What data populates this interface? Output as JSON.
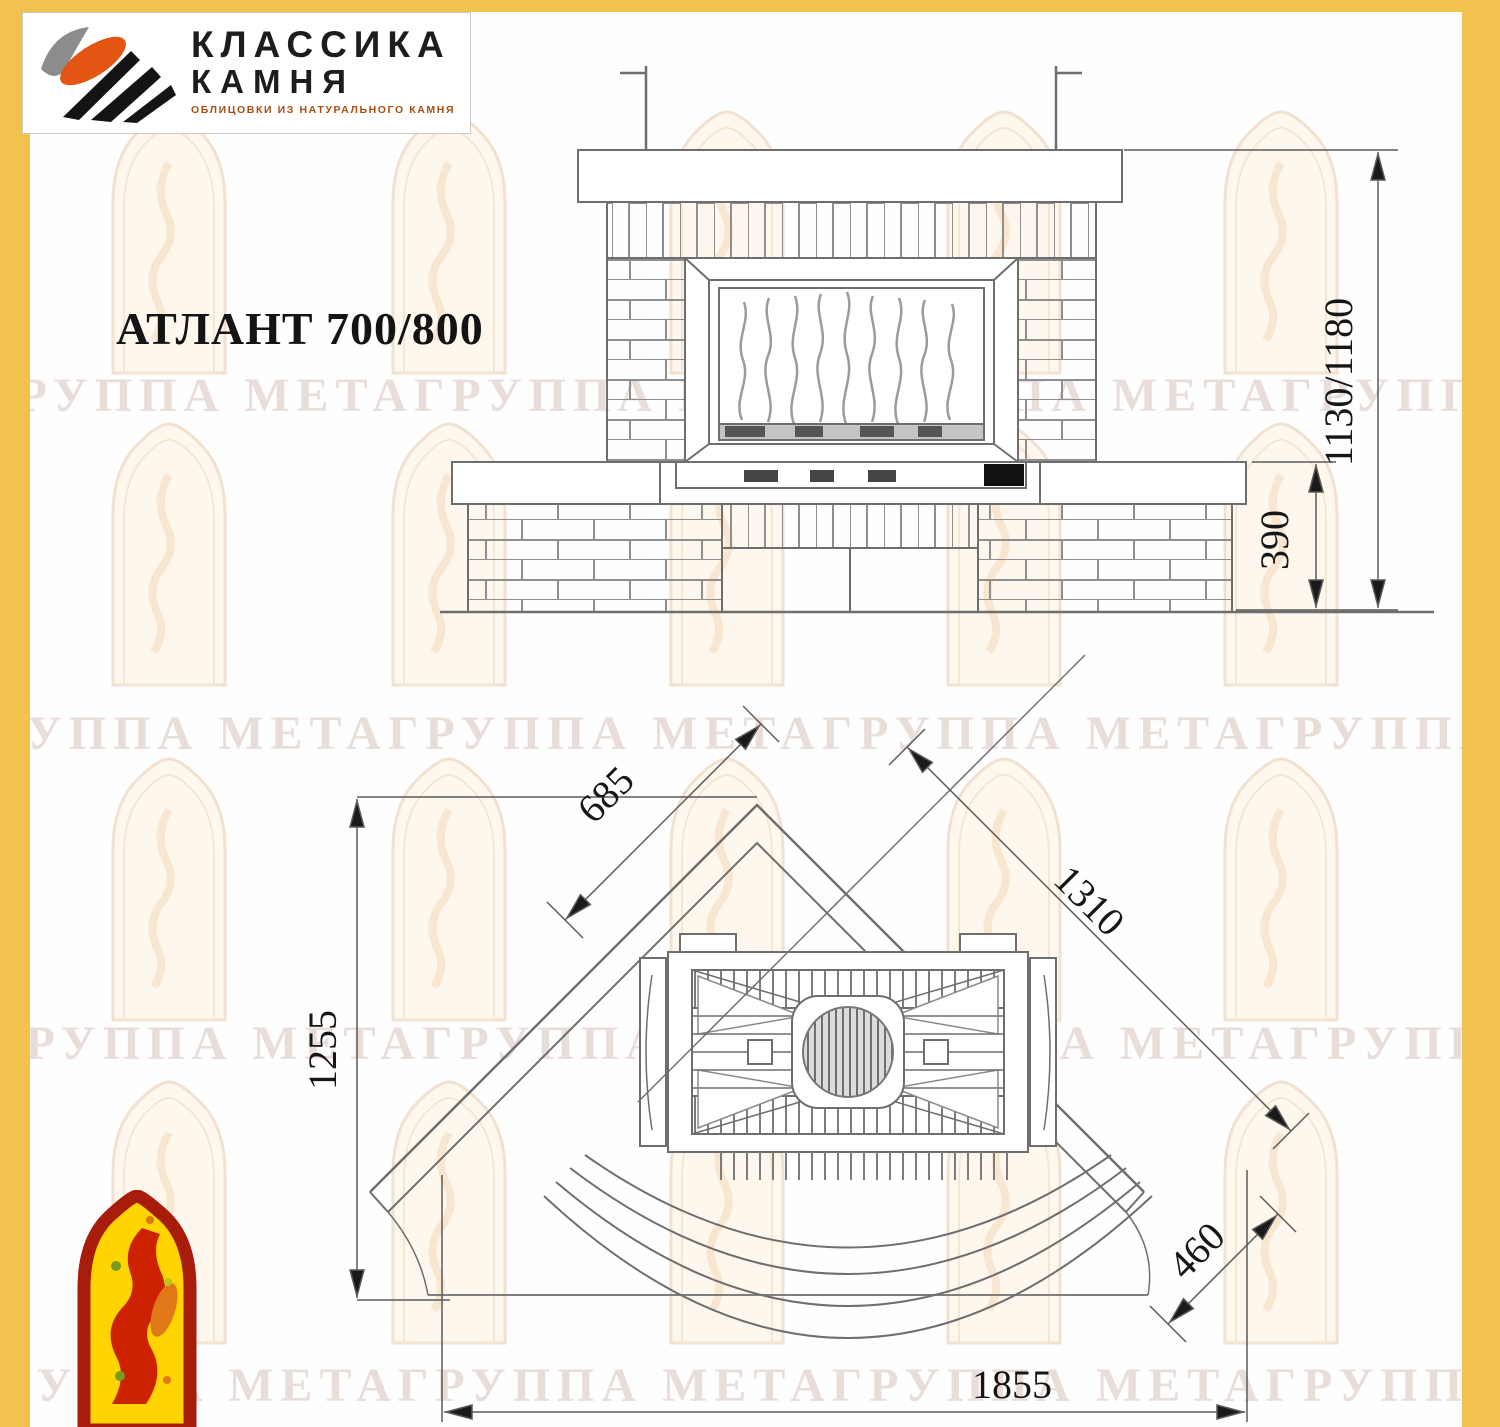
{
  "logo": {
    "line1": "КЛАССИКА",
    "line2": "КАМНЯ",
    "subtitle": "ОБЛИЦОВКИ ИЗ НАТУРАЛЬНОГО КАМНЯ"
  },
  "title": "АТЛАНТ 700/800",
  "watermark": {
    "text": "ГРУППА МЕТАГРУППА МЕТАГРУППА МЕТАГРУППА"
  },
  "drawing": {
    "front_view": {
      "height_label": "1130/1180",
      "hearth_height_label": "390"
    },
    "plan_view": {
      "left_wall_label": "685",
      "diagonal_label": "1310",
      "depth_label": "1255",
      "corner_label": "460",
      "width_label": "1855"
    }
  },
  "colors": {
    "frame_yellow": "#F2C24E",
    "drawing_line_gray": "#6e6e6e",
    "dim_text_black": "#161616",
    "logo_orange": "#E25512",
    "logo_black": "#141414",
    "mascot_red": "#A81C0C",
    "mascot_yellow": "#FFD400",
    "watermark_pink": "#B99187"
  }
}
